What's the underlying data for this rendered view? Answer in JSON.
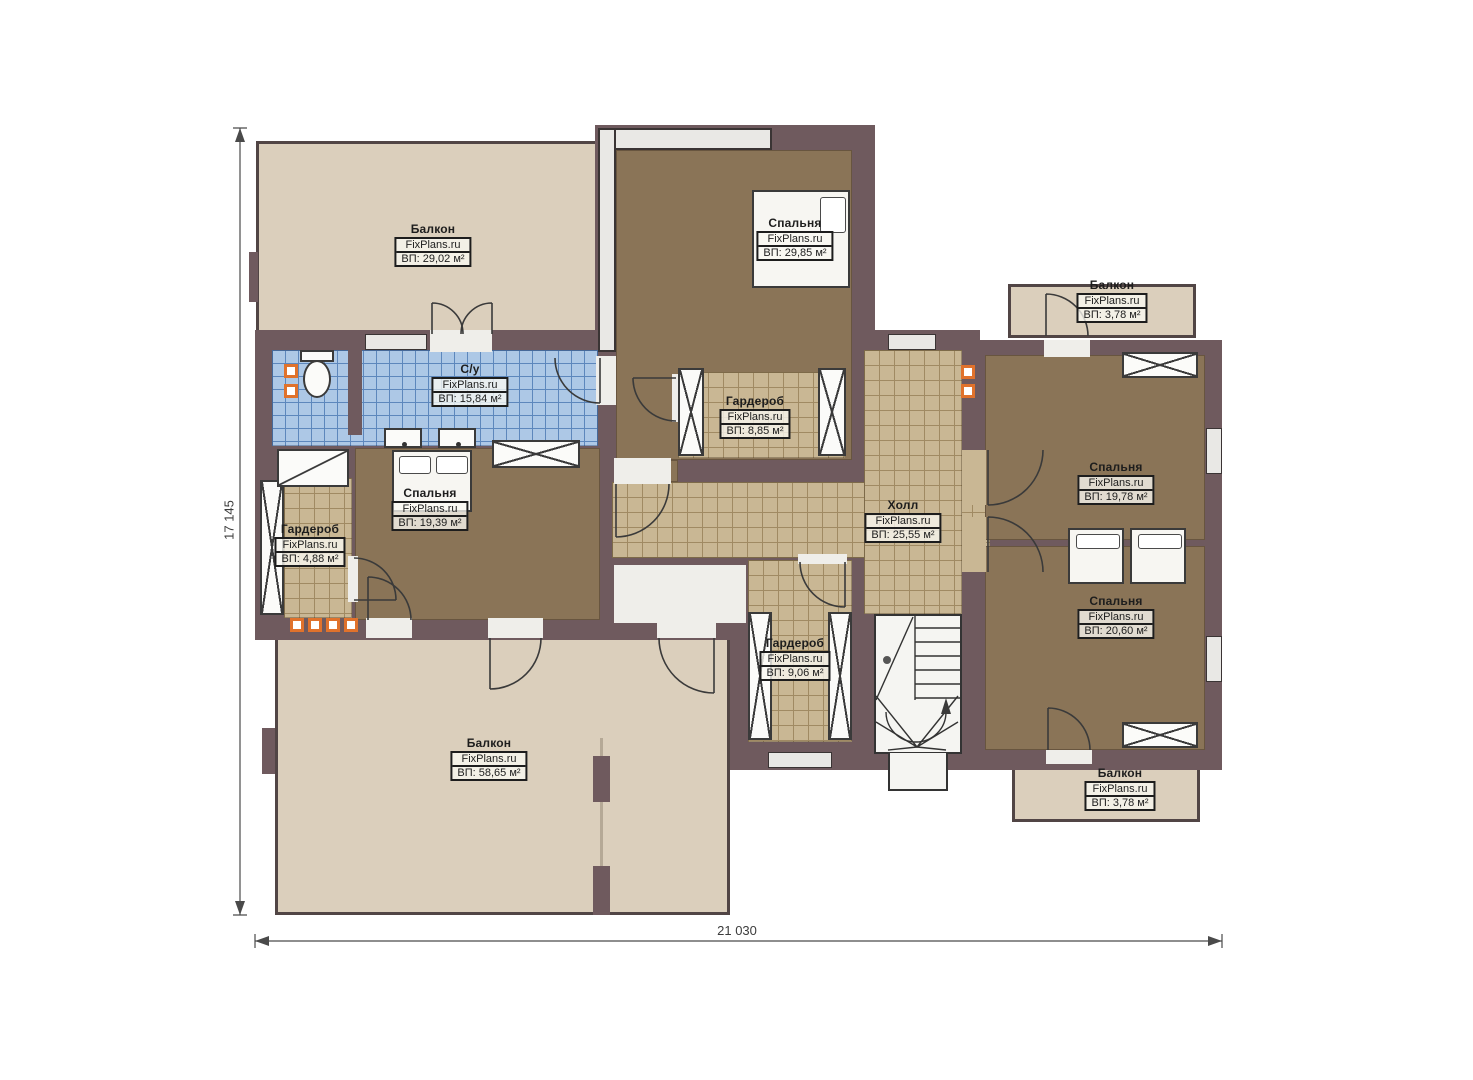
{
  "plan": {
    "watermark": "FixPlans.ru",
    "rooms": [
      {
        "id": "balcony-top-left",
        "name": "Балкон",
        "area": "ВП: 29,02 м²"
      },
      {
        "id": "bedroom-top",
        "name": "Спальня",
        "area": "ВП: 29,85 м²"
      },
      {
        "id": "bathroom",
        "name": "С/у",
        "area": "ВП: 15,84 м²"
      },
      {
        "id": "wardrobe-top",
        "name": "Гардероб",
        "area": "ВП: 8,85 м²"
      },
      {
        "id": "bedroom-left",
        "name": "Спальня",
        "area": "ВП: 19,39 м²"
      },
      {
        "id": "wardrobe-left",
        "name": "Гардероб",
        "area": "ВП: 4,88 м²"
      },
      {
        "id": "hall",
        "name": "Холл",
        "area": "ВП: 25,55 м²"
      },
      {
        "id": "bedroom-right-upper",
        "name": "Спальня",
        "area": "ВП: 19,78 м²"
      },
      {
        "id": "bedroom-right-lower",
        "name": "Спальня",
        "area": "ВП: 20,60 м²"
      },
      {
        "id": "wardrobe-bottom",
        "name": "Гардероб",
        "area": "ВП: 9,06 м²"
      },
      {
        "id": "balcony-bottom-left",
        "name": "Балкон",
        "area": "ВП: 58,65 м²"
      },
      {
        "id": "balcony-top-right",
        "name": "Балкон",
        "area": "ВП: 3,78 м²"
      },
      {
        "id": "balcony-bottom-right",
        "name": "Балкон",
        "area": "ВП: 3,78 м²"
      }
    ],
    "dimensions": {
      "width": "21 030",
      "height": "17 145"
    },
    "colors": {
      "wall": "#6f5a5e",
      "floor_wood": "#8a7457",
      "floor_tile": "#c9b794",
      "floor_blue_tile": "#adc8e6",
      "balcony_floor": "#dbcfbc",
      "vent_orange": "#e0722c"
    }
  }
}
